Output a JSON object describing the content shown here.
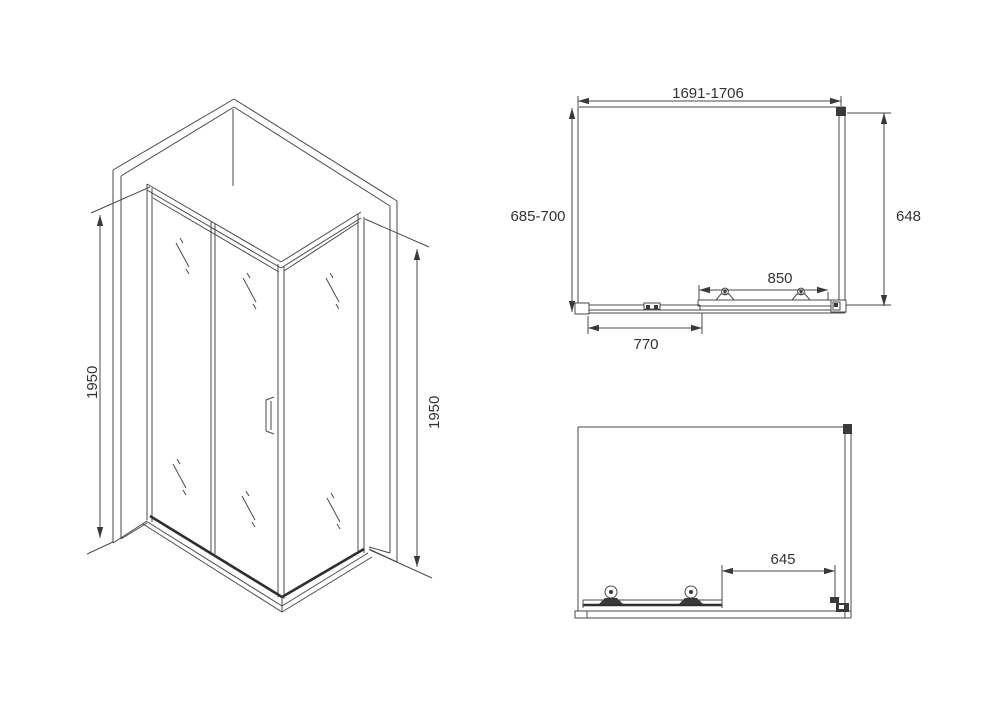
{
  "colors": {
    "background": "#ffffff",
    "line": "#4a4a4a",
    "text": "#333333"
  },
  "isometric_view": {
    "height_left": "1950",
    "height_right": "1950"
  },
  "top_view": {
    "overall_width": "1691-1706",
    "overall_depth": "685-700",
    "side_panel_depth": "648",
    "sliding_door_width": "850",
    "fixed_panel_width": "770"
  },
  "front_view": {
    "opening_width": "645"
  }
}
